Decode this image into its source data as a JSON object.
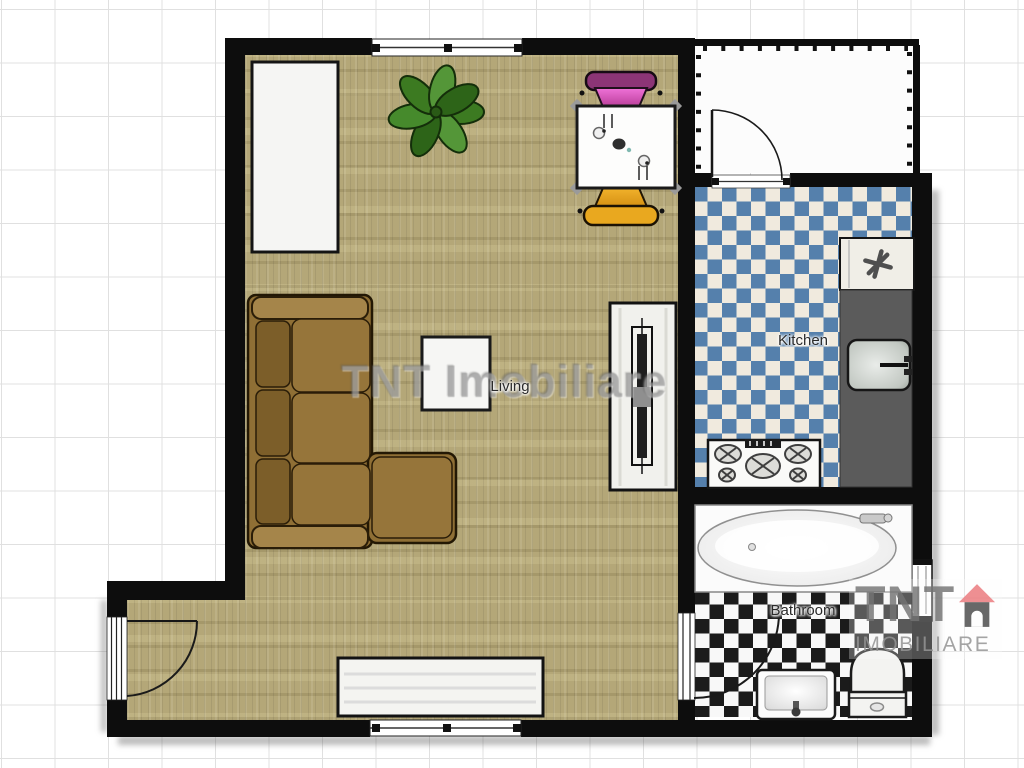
{
  "plan": {
    "watermark": "TNT Imobiliare",
    "rooms": [
      {
        "name": "Living",
        "floor": "wood-planks"
      },
      {
        "name": "Kitchen",
        "floor": "blue-white-checker"
      },
      {
        "name": "Bathroom",
        "floor": "black-white-checker"
      }
    ],
    "logo": {
      "brand": "TNT",
      "subtitle": "IMOBILIARE",
      "roof_color": "#ec7c80",
      "body_color": "#4f4f4f",
      "text_color": "#787878"
    },
    "colors": {
      "wall": "#0d0d0d",
      "wood_floor": "#b4a778",
      "kitchen_tile_blue": "#5580ac",
      "kitchen_tile_cream": "#f0eade",
      "bath_tile_dark": "#1b1b1b",
      "bath_tile_light": "#f8f8f8",
      "sofa_brown": "#8f6f35",
      "chair_pink": "#d84fb4",
      "chair_orange": "#e8a81f",
      "counter_gray": "#5b5b5b",
      "plant_green": "#3c7a21"
    },
    "furniture": [
      "wardrobe",
      "plant",
      "dining-table",
      "pink-chair",
      "orange-chair",
      "l-shaped-sofa",
      "coffee-table",
      "tv-stand",
      "sideboard",
      "fridge",
      "kitchen-counter",
      "kitchen-sink",
      "stove",
      "bathtub",
      "bath-sink",
      "toilet"
    ]
  }
}
